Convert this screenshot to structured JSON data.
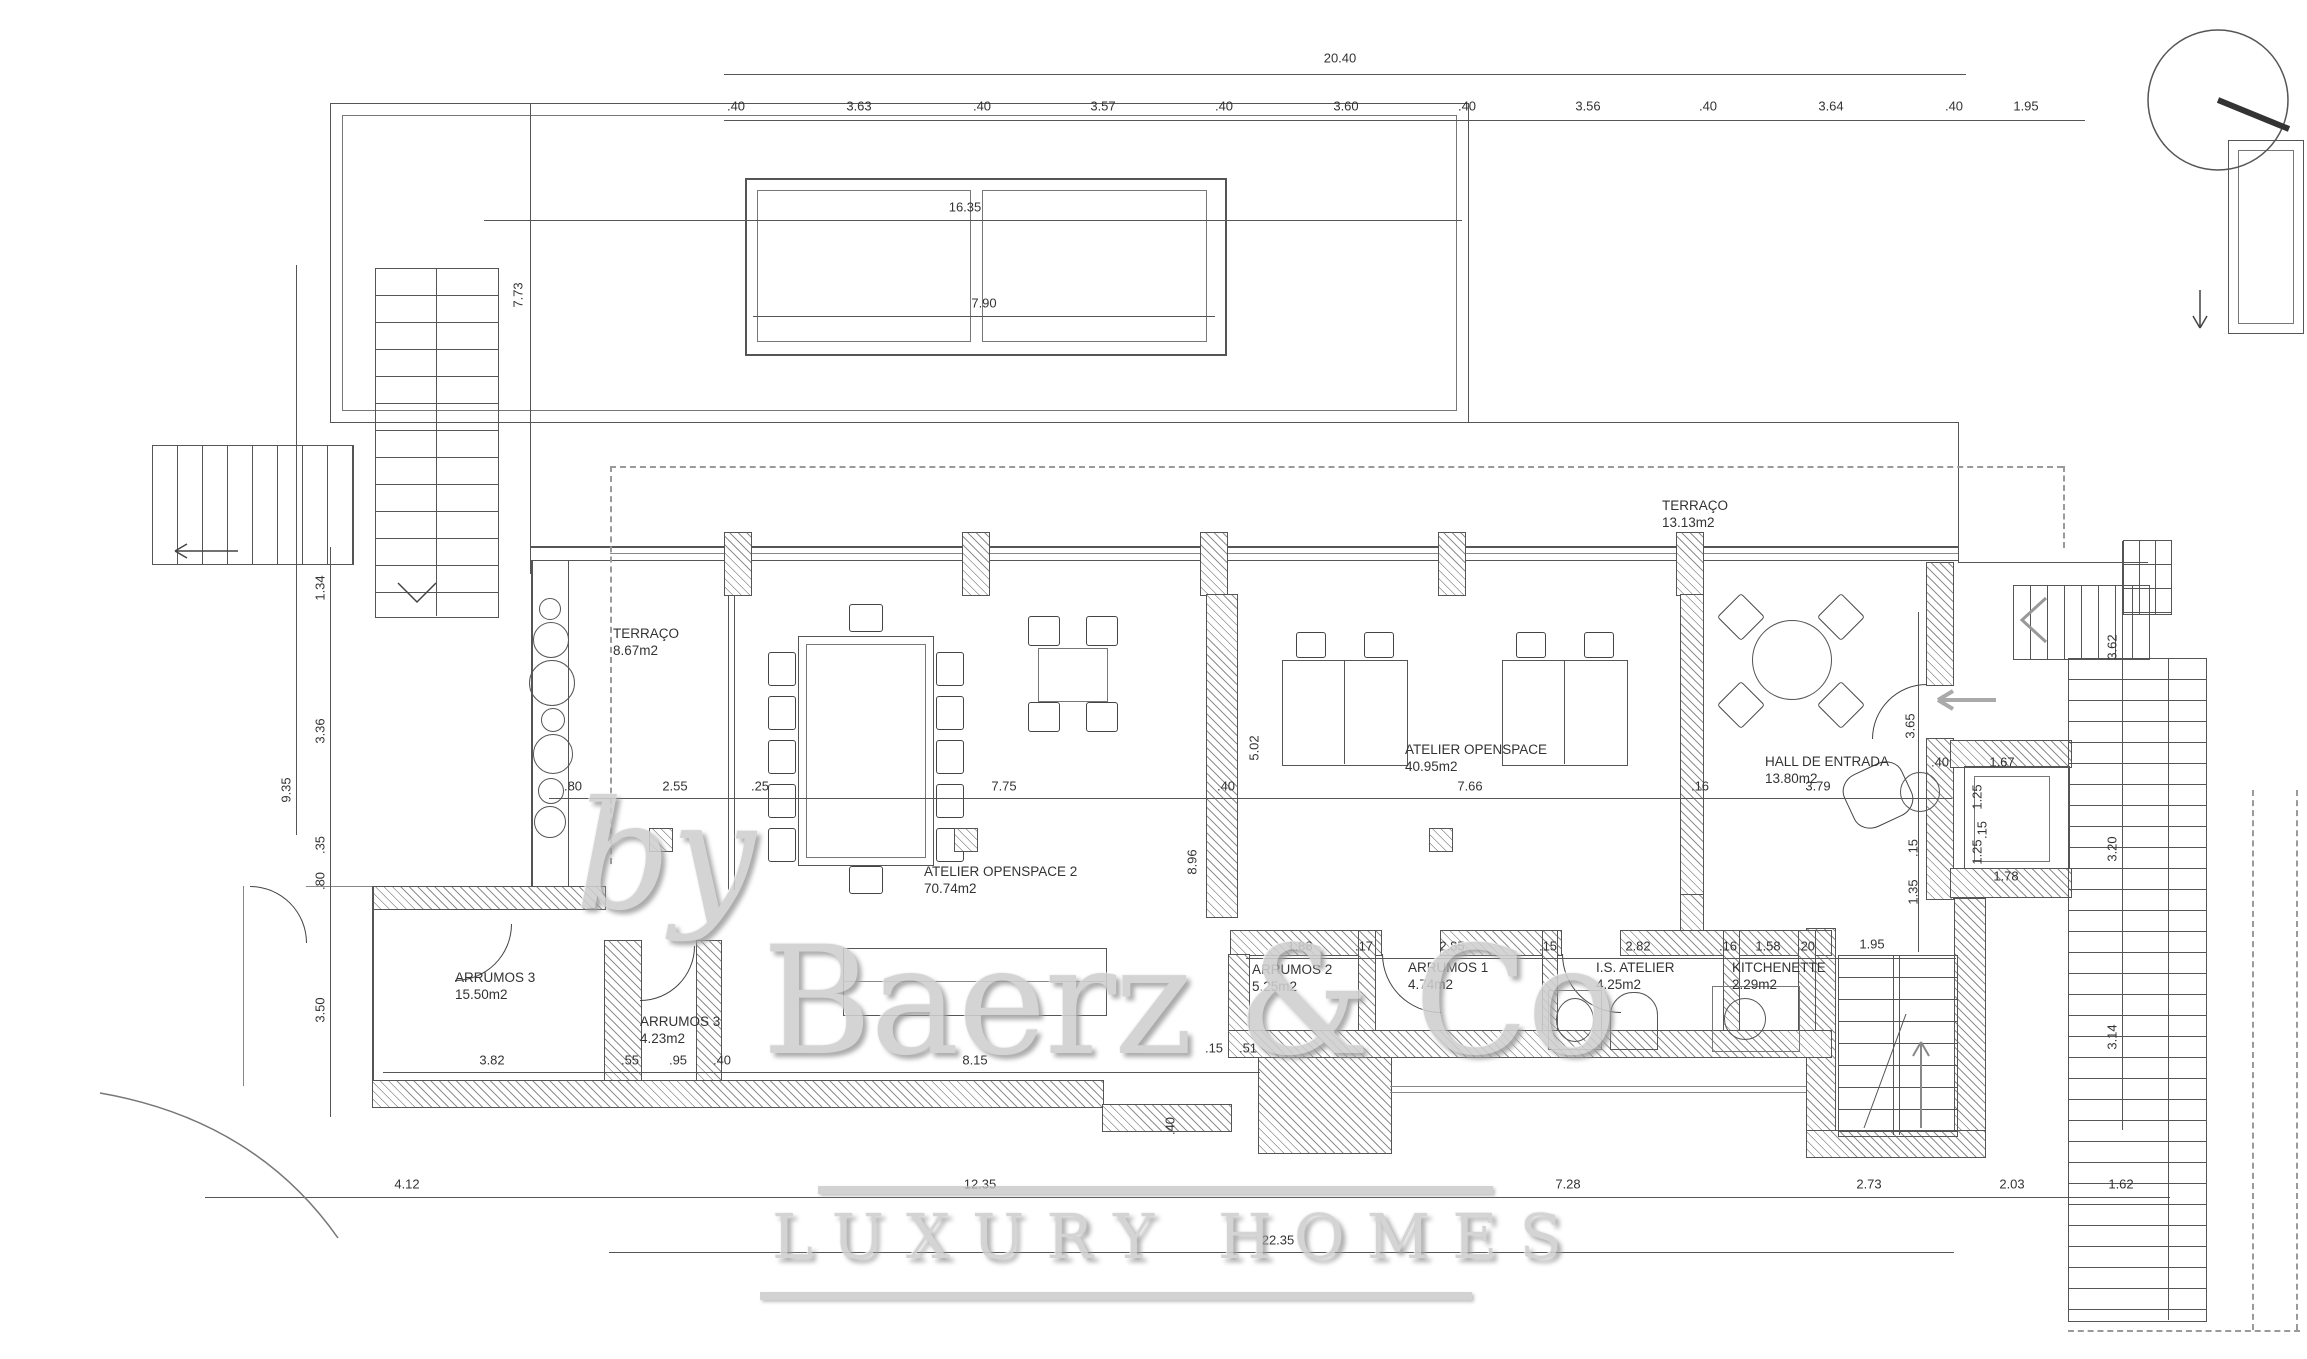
{
  "watermark": {
    "by": "by",
    "brand": "Baerz & Co",
    "tagline": "LUXURY HOMES"
  },
  "rooms": [
    {
      "name": "TERRAÇO",
      "area": "8.67m2"
    },
    {
      "name": "TERRAÇO",
      "area": "13.13m2"
    },
    {
      "name": "ATELIER OPENSPACE",
      "area": "40.95m2"
    },
    {
      "name": "HALL DE ENTRADA",
      "area": "13.80m2"
    },
    {
      "name": "ATELIER OPENSPACE 2",
      "area": "70.74m2"
    },
    {
      "name": "ARRUMOS 3",
      "area": "15.50m2"
    },
    {
      "name": "ARRUMOS 3",
      "area": "4.23m2"
    },
    {
      "name": "ARRUMOS 2",
      "area": "5.25m2"
    },
    {
      "name": "ARRUMOS 1",
      "area": "4.74m2"
    },
    {
      "name": "I.S. ATELIER",
      "area": "4.25m2"
    },
    {
      "name": "KITCHENETTE",
      "area": "2.29m2"
    }
  ],
  "dims": {
    "top_total": "20.40",
    "top_chain": [
      ".40",
      "3.63",
      ".40",
      "3.57",
      ".40",
      "3.60",
      ".40",
      "3.56",
      ".40",
      "3.64",
      ".40",
      "1.95"
    ],
    "plan_width": "16.35",
    "pool_width": "7.90",
    "left_height": "7.73",
    "left_inner": "9.35",
    "left_chain": [
      "1.34",
      "3.36",
      ".35",
      ".80",
      "3.50"
    ],
    "mid_row": [
      ".80",
      "2.55",
      ".25",
      "7.75",
      ".40",
      "7.66",
      ".16",
      "3.79",
      ".40"
    ],
    "wall_upper": "5.02",
    "wall_lower": "8.96",
    "entry_height": "3.65",
    "lift_w": "1.67",
    "lift_h1": "1.25",
    "lift_gap": ".15",
    "lift_h2": "1.25",
    "lift_w2": "1.78",
    "hall_gap": ".15",
    "hall_h": "1.35",
    "stair_w": "1.95",
    "rooms_row": [
      "1.88",
      ".17",
      "2.85",
      ".15",
      "2.82",
      ".16",
      "1.58",
      ".20"
    ],
    "bottom_left_row": [
      "3.82",
      ".55",
      ".95",
      ".40",
      "8.15",
      ".15",
      ".51"
    ],
    "step": ".40",
    "bottom_row": [
      "4.12",
      "12.35",
      "7.28",
      "2.73",
      "2.03",
      "1.62"
    ],
    "bottom_total": "22.35",
    "right_chain": [
      "3.62",
      "3.20",
      "3.14"
    ]
  }
}
